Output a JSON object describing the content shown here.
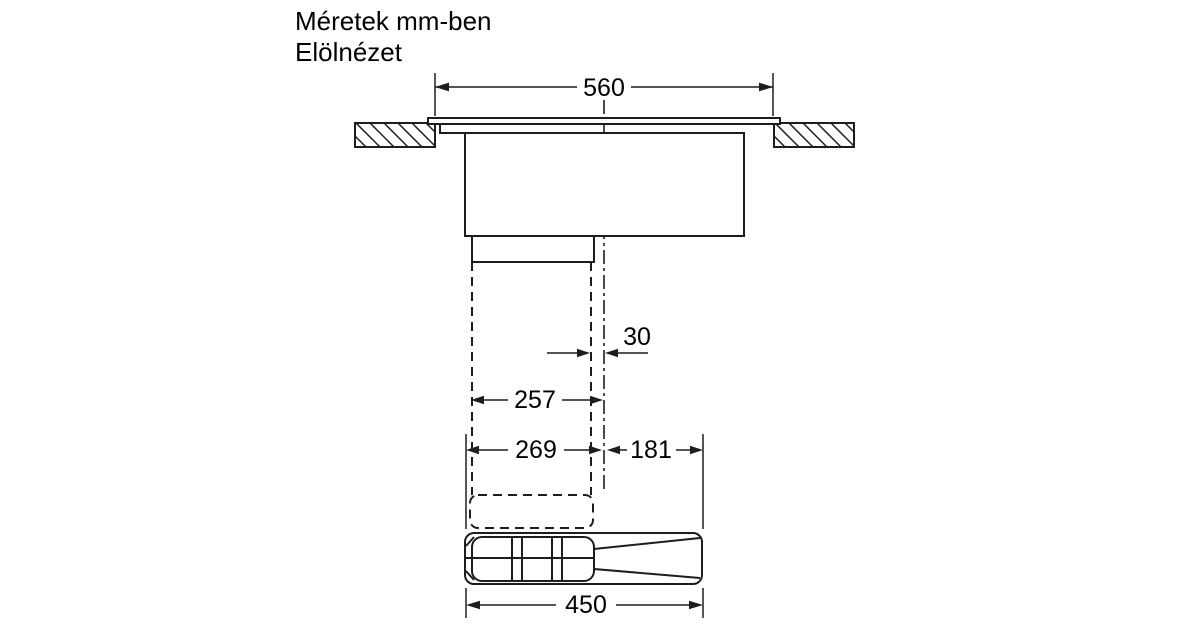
{
  "title": {
    "line1": "Méretek mm-ben",
    "line2": "Elölnézet"
  },
  "dimensions": {
    "top_cutout_width": "560",
    "duct_offset": "30",
    "duct_width": "257",
    "left_of_center": "269",
    "right_of_center": "181",
    "bottom_unit_width": "450"
  },
  "colors": {
    "line": "#1d1d1d",
    "background": "#ffffff",
    "text": "#000000"
  }
}
